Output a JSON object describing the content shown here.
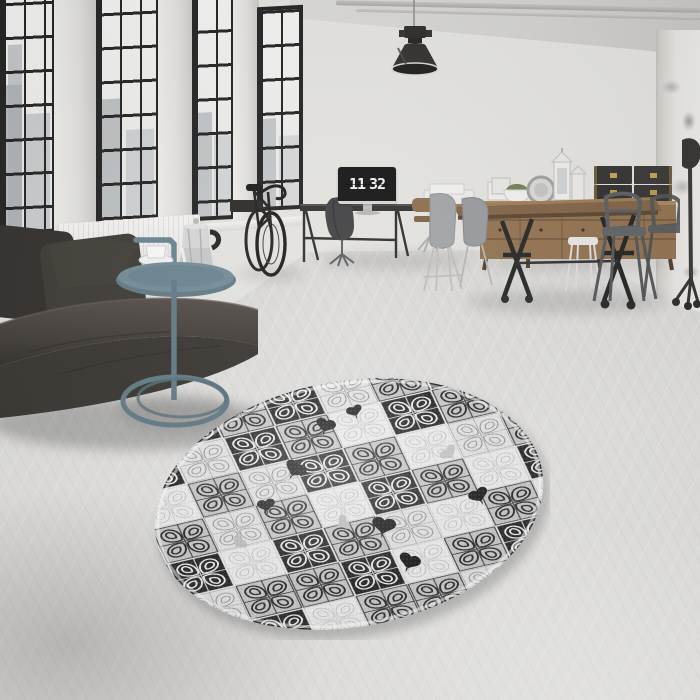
{
  "clock": {
    "hours": "11",
    "minutes": "32"
  },
  "scene": {
    "description": "Industrial loft living room with round patchwork rug",
    "objects": [
      "factory-windows-with-city-view",
      "radiator",
      "leather-sofa",
      "dark-pillows",
      "teal-side-table",
      "moka-pot",
      "espresso-cup",
      "wall-mounted-bicycle",
      "industrial-pendant-lamp",
      "ceiling-pipes",
      "desk",
      "monitor-flip-clock",
      "office-chair-with-jacket",
      "wooden-office-chairs",
      "eames-style-chairs",
      "industrial-dining-table",
      "tolix-metal-chairs",
      "wooden-sideboard",
      "storage-chests",
      "white-lanterns",
      "moss-plant",
      "round-mirror",
      "picture-frames",
      "tripod-floor-lamp",
      "round-patchwork-rug",
      "concrete-floor"
    ]
  },
  "colors": {
    "wall": "#e3e2de",
    "window_frame": "#1c1c1c",
    "sofa_leather": "#413c38",
    "side_table_teal": "#64808d",
    "wood": "#8f6e4b",
    "floor": "#d9d8d6",
    "rug_black": "#1e1e1e",
    "rug_gray": "#c7c7c7",
    "rug_light": "#e6e6e6"
  },
  "rug": {
    "palette": {
      "base": "#e9e9e9",
      "K": {
        "bg": "#1e1e1e",
        "stroke": "#ededed",
        "sw": 2
      },
      "G": {
        "bg": "#c6c6c6",
        "stroke": "#242424",
        "sw": 2
      },
      "L": {
        "bg": "#e3e3e3",
        "stroke": "#969696",
        "sw": 1.2
      },
      "W": {
        "bg": "#ececec",
        "stroke": "#c2c2c2",
        "sw": 1
      },
      "P": {
        "bg": "#b4b4b4",
        "stroke": "#858585",
        "sw": 1.2
      }
    },
    "tiles": [
      "WGKGKLGKG",
      "GKLKGWKGL",
      "LWGLKGWLG",
      "KGLGWKGWK",
      "GKWKGLWGW",
      "WLGGKWGKG",
      "GWKWGGLWL",
      "LGWKWLGGW"
    ],
    "hearts": [
      {
        "x": 178,
        "y": 52,
        "s": 1.0,
        "r": 15,
        "c": "#161616"
      },
      {
        "x": 206,
        "y": 38,
        "s": 0.8,
        "r": -20,
        "c": "#1a1a1a"
      },
      {
        "x": 148,
        "y": 96,
        "s": 1.1,
        "r": 30,
        "c": "#141414"
      },
      {
        "x": 118,
        "y": 132,
        "s": 0.9,
        "r": -10,
        "c": "#1a1a1a"
      },
      {
        "x": 236,
        "y": 152,
        "s": 1.2,
        "r": 10,
        "c": "#121212"
      },
      {
        "x": 330,
        "y": 122,
        "s": 1.0,
        "r": -25,
        "c": "#1a1a1a"
      },
      {
        "x": 262,
        "y": 188,
        "s": 1.1,
        "r": 20,
        "c": "#141414"
      },
      {
        "x": 92,
        "y": 170,
        "s": 0.8,
        "r": 40,
        "c": "#bdbdbd"
      },
      {
        "x": 300,
        "y": 80,
        "s": 0.9,
        "r": -40,
        "c": "#c4c4c4"
      },
      {
        "x": 196,
        "y": 150,
        "s": 0.8,
        "r": 60,
        "c": "#bdbdbd"
      }
    ]
  }
}
